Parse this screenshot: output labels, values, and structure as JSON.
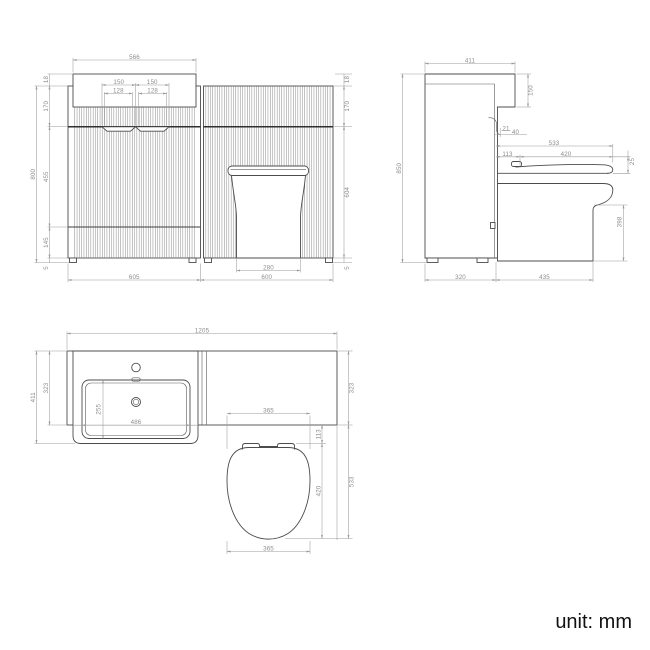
{
  "unit_label": "unit: mm",
  "front_view": {
    "basin_top_width": "566",
    "handle_left_width": "150",
    "handle_right_width": "150",
    "handle_left_inner": "128",
    "handle_right_inner": "128",
    "counter_thickness": "18",
    "upper_band_height": "170",
    "mid_height": "455",
    "lower_height": "145",
    "floor_gap": "5",
    "total_height": "800",
    "right_counter_thickness": "18",
    "right_upper_band_height": "170",
    "toilet_panel_height": "604",
    "right_floor_gap": "5",
    "toilet_base_width": "280",
    "vanity_width": "605",
    "toilet_unit_width": "600"
  },
  "side_view": {
    "counter_depth": "411",
    "basin_drop": "150",
    "hook_offset": "21",
    "hook_depth": "40",
    "toilet_depth_total": "533",
    "seat_back_offset": "113",
    "seat_length": "420",
    "seat_thickness": "25",
    "pan_front_height": "398",
    "total_height": "850",
    "cabinet_depth": "320",
    "pan_depth": "435"
  },
  "plan_view": {
    "total_width": "1205",
    "counter_depth_with_basin": "411",
    "counter_depth": "323",
    "basin_depth": "255",
    "basin_width": "486",
    "right_counter_depth": "323",
    "seat_width": "365",
    "seat_back_offset": "113",
    "seat_length": "420",
    "seat_depth_total": "533",
    "seat_width_bottom": "365"
  }
}
